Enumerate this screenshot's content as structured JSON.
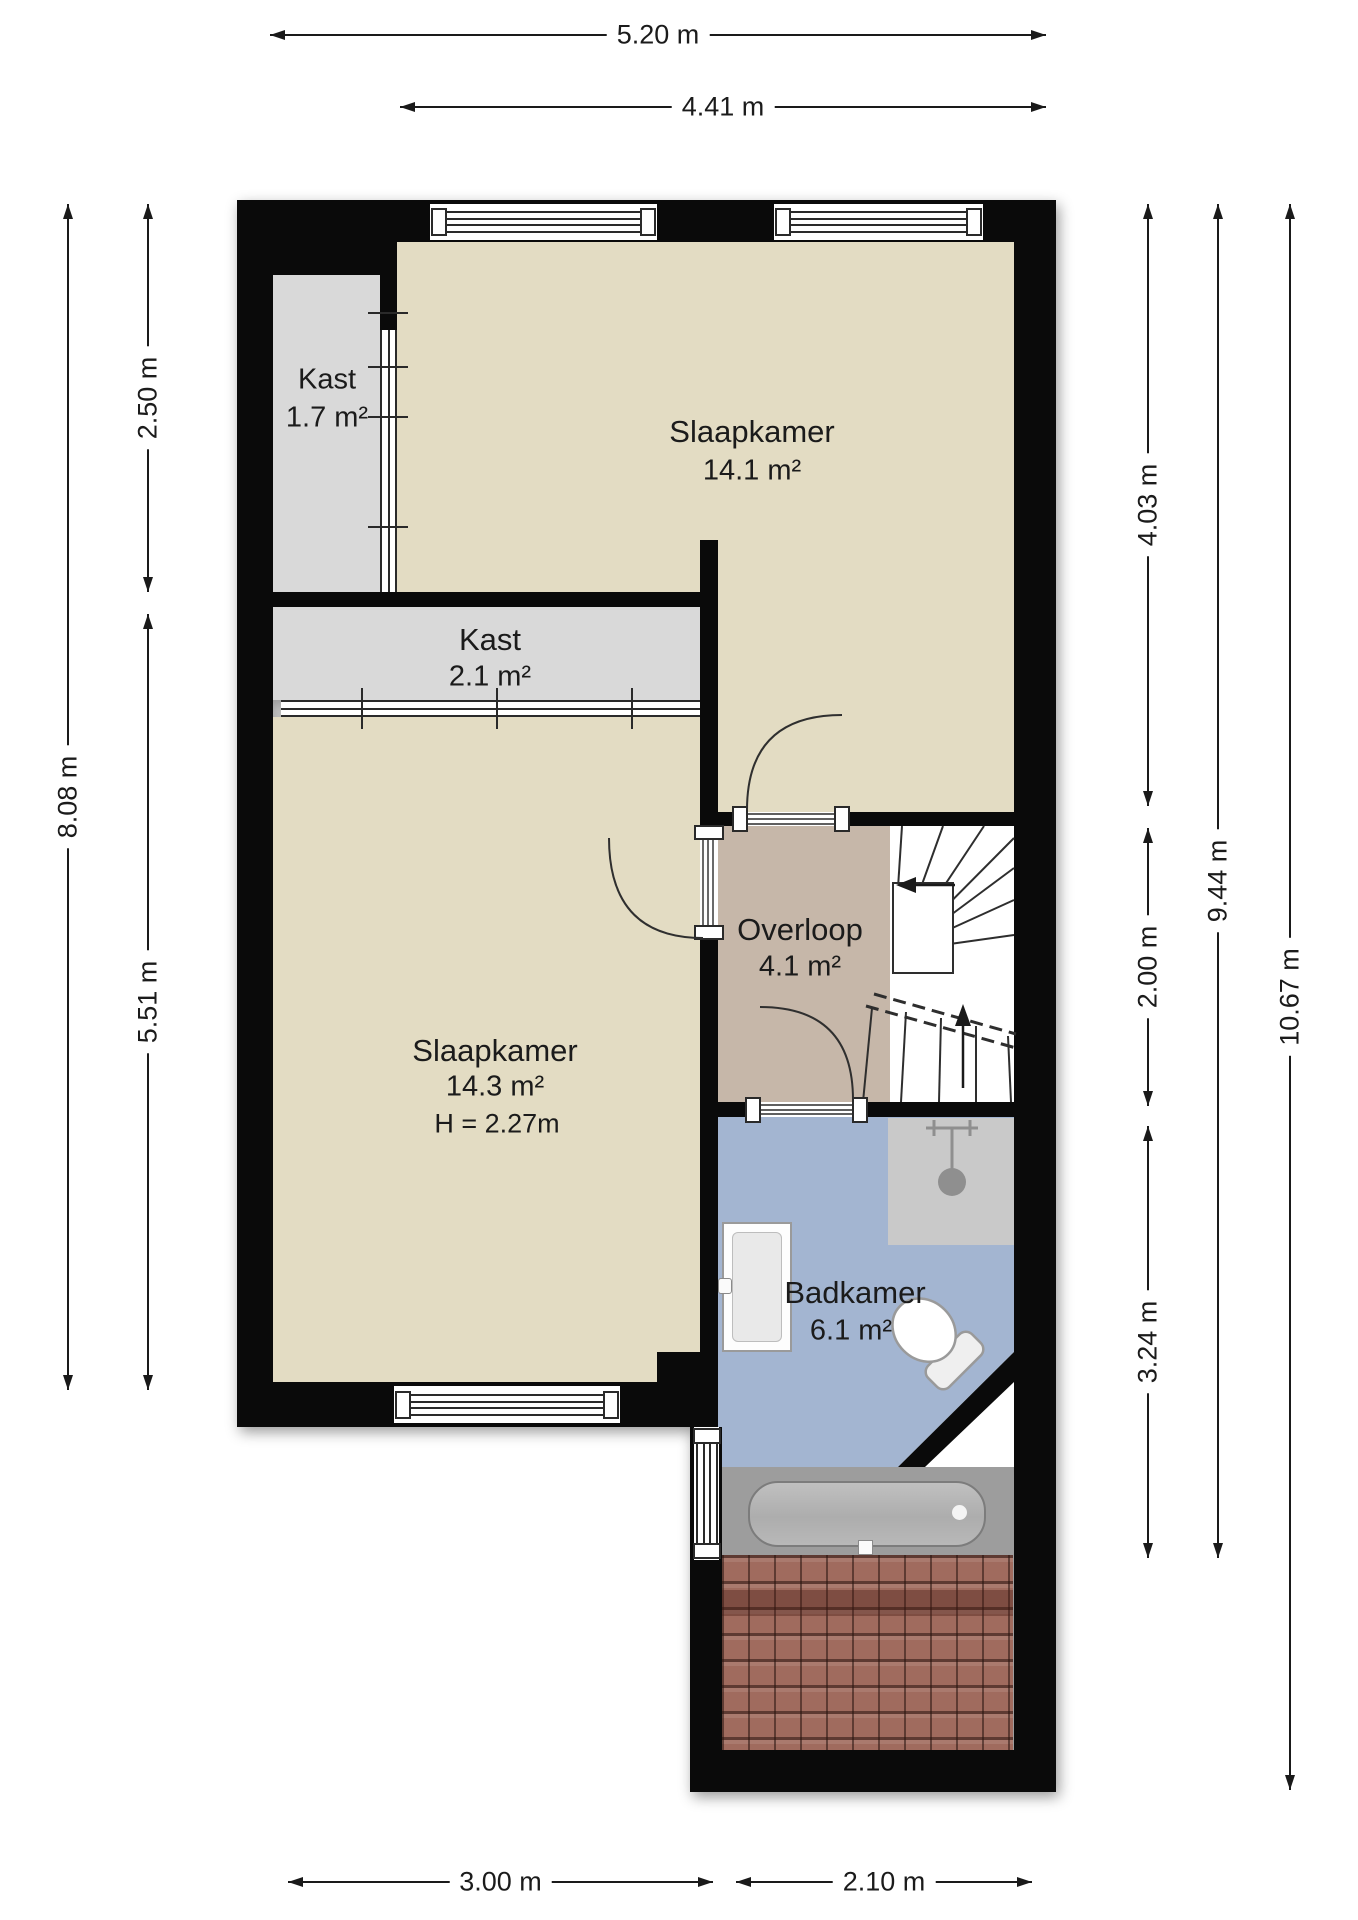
{
  "plan": {
    "title": "floorplan-first-floor",
    "rooms": {
      "kast1": {
        "name": "Kast",
        "area": "1.7 m²"
      },
      "slaapkamer1": {
        "name": "Slaapkamer",
        "area": "14.1 m²"
      },
      "kast2": {
        "name": "Kast",
        "area": "2.1 m²"
      },
      "slaapkamer2": {
        "name": "Slaapkamer",
        "area": "14.3 m²",
        "ceiling_height": "H = 2.27m"
      },
      "overloop": {
        "name": "Overloop",
        "area": "4.1 m²"
      },
      "badkamer": {
        "name": "Badkamer",
        "area": "6.1 m²"
      }
    },
    "dimensions": {
      "top_total": "5.20 m",
      "top_inner": "4.41 m",
      "left_upper": "2.50 m",
      "left_total": "8.08 m",
      "left_lower": "5.51 m",
      "right_upper": "4.03 m",
      "right_middle": "2.00 m",
      "right_lower": "3.24 m",
      "right_inner_total": "9.44 m",
      "right_total": "10.67 m",
      "bottom_left": "3.00 m",
      "bottom_right": "2.10 m"
    },
    "colors": {
      "wall": "#0a0a0a",
      "floor_bedroom": "#e3dcc3",
      "floor_closet": "#d9d9d9",
      "floor_landing": "#c6b7a9",
      "floor_bathroom": "#a3b5d1",
      "shower_area": "#c9c9c9",
      "roof_tiles": "#a06b5e",
      "dimension_text": "#1a1a1a"
    }
  }
}
